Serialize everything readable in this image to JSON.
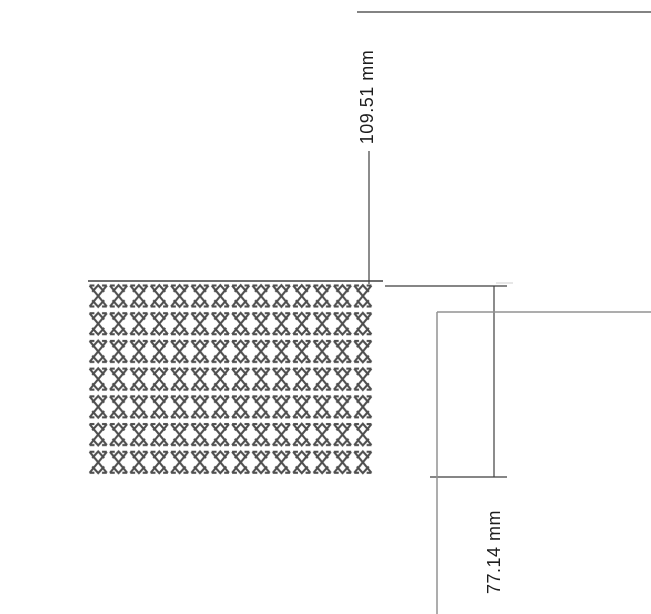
{
  "drawing": {
    "dimensions": [
      {
        "id": "vertical-offset",
        "label": "109.51 mm"
      },
      {
        "id": "pattern-height",
        "label": "77.14 mm"
      }
    ],
    "pattern_block": {
      "glyph_icon": "x-hatch-glyph",
      "rows": 7,
      "cols": 14,
      "glyph_color": "#4e4e4e"
    },
    "colors": {
      "background": "#ffffff",
      "dimension_line": "#3f3f3f",
      "edge_line": "#5a5a5a",
      "pattern_edge_line": "#6e6e6e",
      "part_outline_gray": "#929292",
      "text": "#1d1d1d"
    }
  }
}
